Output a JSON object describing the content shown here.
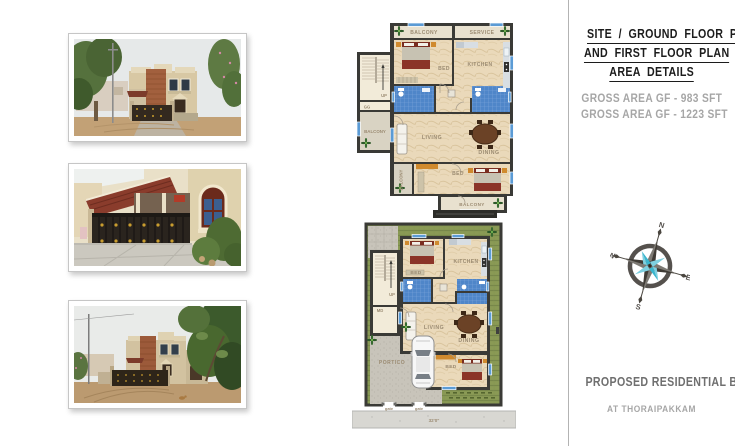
{
  "right_panel": {
    "title_lines": [
      "SITE / GROUND FLOOR PLAN",
      "AND FIRST FLOOR PLAN",
      "AREA DETAILS"
    ],
    "area_lines": [
      "GROSS AREA GF - 983 SFT",
      "GROSS AREA GF - 1223 SFT"
    ],
    "footer_title": "PROPOSED RESIDENTIAL BUILDING",
    "footer_subtitle": "AT THORAIPAKKAM",
    "compass": {
      "n": "N",
      "e": "E",
      "s": "S",
      "w": "W",
      "accent_color": "#3ab6ce"
    }
  },
  "first_floor_plan": {
    "balcony_top": "BALCONY",
    "service": "SERVICE",
    "bed_top": "BED",
    "kitchen": "KITCHEN",
    "stair_up": "UP",
    "stair_landing": "GG",
    "balcony_left": "BALCONY",
    "living": "LIVING",
    "dining": "DINING",
    "bed_bottom": "BED",
    "balcony_side": "BALCONY",
    "balcony_bottom": "BALCONY"
  },
  "ground_floor_plan": {
    "bed_top": "BED",
    "kitchen": "KITCHEN",
    "stair_up": "UP",
    "main_door": "MD",
    "living": "LIVING",
    "dining": "DINING",
    "bed_bottom": "BED",
    "portico": "PORTICO",
    "gate_left": "gate",
    "gate_right": "gate",
    "road_dimension": "32'0\""
  },
  "palette": {
    "wall": "#3a3a36",
    "floor_marble": "#ead9ba",
    "bath_tile": "#4f86c9",
    "grass": "#8a9a55",
    "accent_orange": "#d08a2e",
    "bed_maroon": "#7a2d20",
    "window_blue": "#5b9bd5",
    "compass_cyan": "#3ab6ce"
  }
}
